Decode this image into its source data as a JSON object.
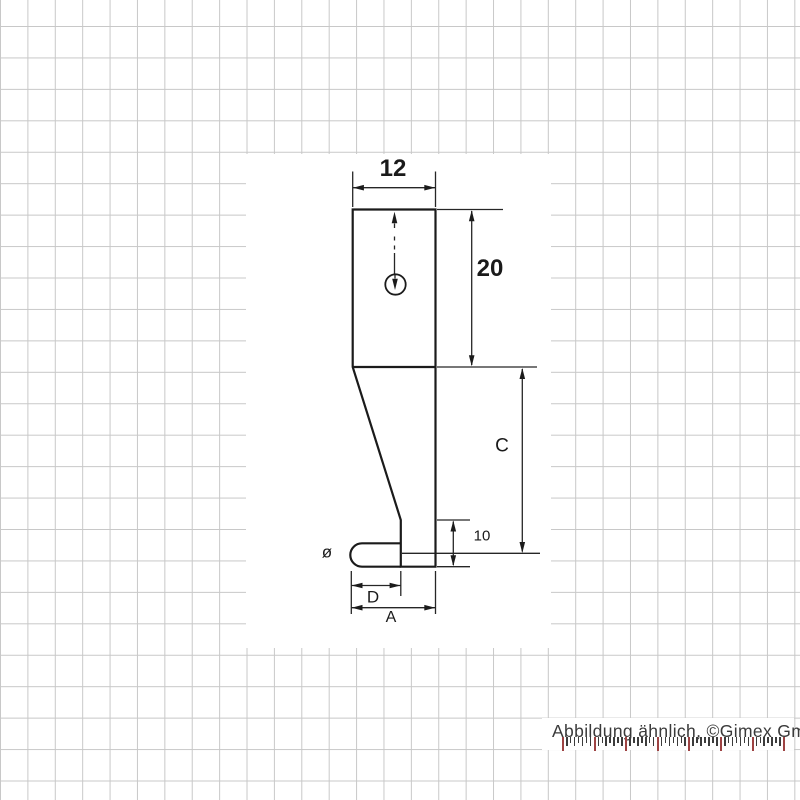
{
  "drawing": {
    "title": "lever probe side-view technical drawing",
    "dimensions": {
      "width_top": "12",
      "height_upper": "20",
      "height_c": "C",
      "height_step": "10",
      "diameter_symbol": "ø",
      "length_d": "D",
      "length_a": "A"
    },
    "colors": {
      "outline": "#1b1b1b",
      "dimension_lines": "#262626",
      "grid": "#c8c8c8"
    }
  },
  "caption": {
    "text": "Abbildung ähnlich, ©Gimex GmbH"
  },
  "ruler": {
    "major_count": 8,
    "minors_per_major": 7,
    "major_spacing": 31.6,
    "major_height": 14,
    "minor_height_tall": 9,
    "minor_height_short": 6,
    "major_color": "#9e4343",
    "minor_color": "#3c3c3c"
  }
}
